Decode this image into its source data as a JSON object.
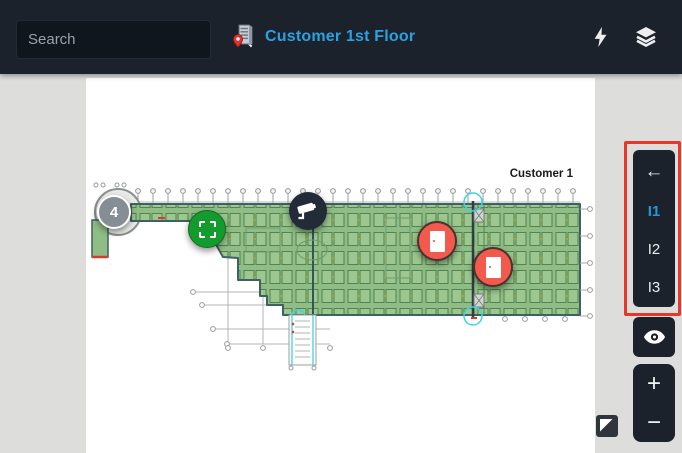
{
  "topbar": {
    "search": {
      "placeholder": "Search"
    },
    "title": "Customer 1st Floor",
    "icons": [
      "search-icon",
      "building-pin-icon",
      "lightning-icon",
      "layers-icon"
    ]
  },
  "map": {
    "area_label": "Customer 1",
    "markers": [
      {
        "name": "cluster-marker",
        "type": "cluster",
        "label": "4",
        "x": 28,
        "y": 134,
        "d": 34,
        "color": "#868e95"
      },
      {
        "name": "zone-marker",
        "type": "zone",
        "x": 121,
        "y": 151,
        "d": 38,
        "color": "#149b2d"
      },
      {
        "name": "camera-marker",
        "type": "camera",
        "x": 222,
        "y": 133,
        "d": 38,
        "color": "#232b38"
      },
      {
        "name": "door-marker-1",
        "type": "door",
        "x": 351,
        "y": 163,
        "d": 40,
        "color": "#f25a4d"
      },
      {
        "name": "door-marker-2",
        "type": "door",
        "x": 407,
        "y": 189,
        "d": 40,
        "color": "#f25a4d"
      }
    ]
  },
  "toolbar": {
    "back_icon": "←",
    "levels": [
      {
        "label": "I1",
        "active": true
      },
      {
        "label": "I2",
        "active": false
      },
      {
        "label": "I3",
        "active": false
      }
    ],
    "zoom_in_label": "+",
    "zoom_out_label": "−",
    "highlight_color": "#e9362a",
    "active_color": "#1e9bd7"
  },
  "colors": {
    "topbar_bg": "#1b222c",
    "accent_blue": "#2aa1e0",
    "plan_green": "#8fbd85",
    "marker_red": "#f25a4d",
    "marker_green": "#149b2d",
    "marker_gray": "#868e95",
    "marker_dark": "#232b38"
  }
}
